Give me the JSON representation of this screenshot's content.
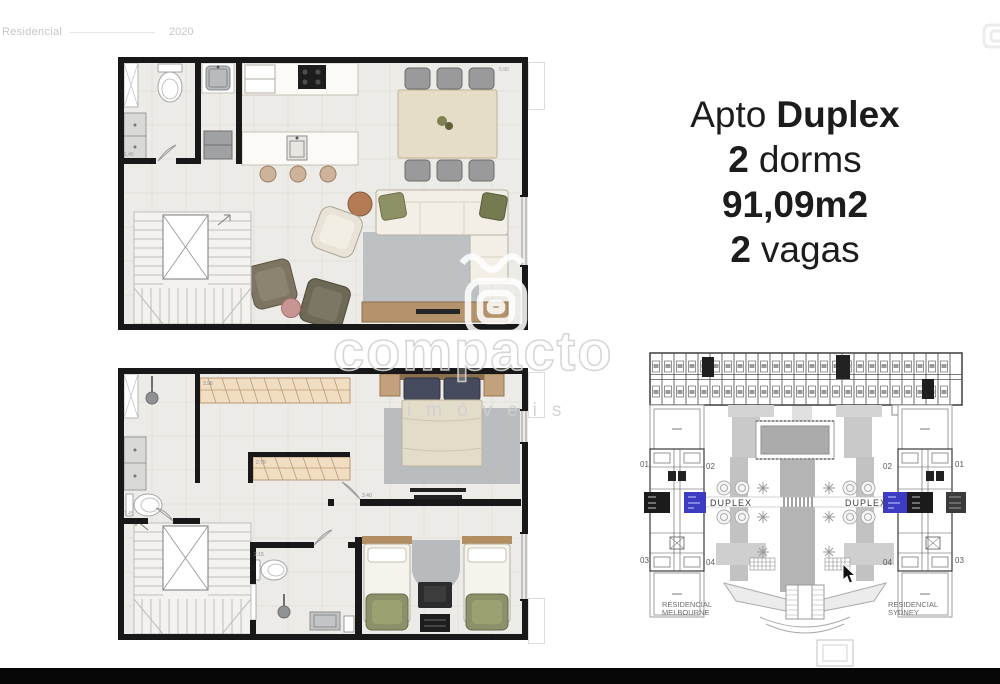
{
  "header": {
    "label": "Residencial",
    "year": "2020"
  },
  "listing": {
    "line1_regular": "Apto",
    "line1_bold": "Duplex",
    "line2_bold": "2",
    "line2_regular": "dorms",
    "line3_bold": "91,09m2",
    "line4_bold": "2",
    "line4_regular": "vagas"
  },
  "watermark": {
    "brand": "compacto",
    "subtitle": "imóveis"
  },
  "plans": {
    "upper": {
      "dim_top_right": "5.90",
      "dim_left": "1.45"
    },
    "lower": {
      "dim_left": "1.45",
      "dim_wardrobe_top": "3.96",
      "dim_wardrobe_mid": "2.75",
      "dim_bedroom_wall": "3.40",
      "dim_bathroom": "2.15"
    }
  },
  "siteplan": {
    "highlight_color": "#3c3cc2",
    "left_tower": {
      "units": [
        "01",
        "02",
        "03",
        "04"
      ],
      "duplex_label": "DUPLEX",
      "name_line1": "RESIDENCIAL",
      "name_line2": "MELBOURNE"
    },
    "right_tower": {
      "units": [
        "02",
        "01",
        "04",
        "03"
      ],
      "duplex_label": "DUPLEX",
      "name_line1": "RESIDENCIAL",
      "name_line2": "SYDNEY"
    }
  }
}
